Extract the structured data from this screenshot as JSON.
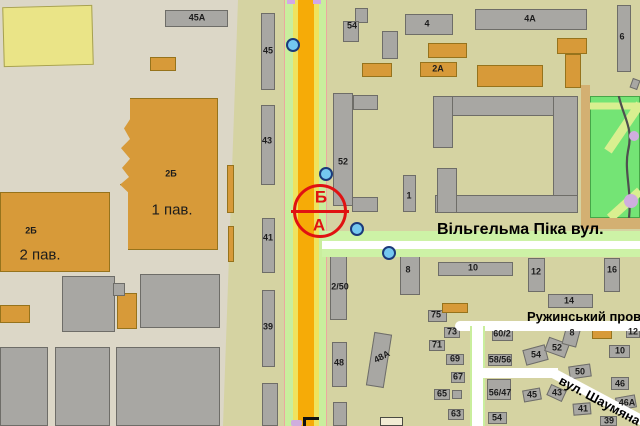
{
  "map": {
    "palette": {
      "district_left_bg": "#dcd7c7",
      "district_right_bg": "#d5d3a2",
      "building_gray": "#a8a7a3",
      "building_orange": "#d79a39",
      "building_yellow": "#eae487",
      "building_cream": "#f2ecd4",
      "road_orange": "#f6ab07",
      "road_yellow": "#efe35e",
      "road_green": "#c9ee9d",
      "street_white": "#ffffff",
      "street_green": "#cdf2a6",
      "marker_blue": "#74c8f0",
      "accent_red": "#e01212",
      "park_green": "#74e475",
      "park_path": "#d9ef90",
      "lavender": "#cfaede"
    },
    "streets": {
      "pika": {
        "label": "Вільгельма Піка вул."
      },
      "ruzhynskyi": {
        "label": "Ружинський пров."
      },
      "shaumiana": {
        "label": "вул. Шаумяна"
      }
    },
    "poi": {
      "top_label": "Б",
      "bottom_label": "А"
    },
    "blue_markers": [
      {
        "x": 293,
        "y": 45
      },
      {
        "x": 326,
        "y": 174
      },
      {
        "x": 357,
        "y": 229
      },
      {
        "x": 389,
        "y": 253
      }
    ],
    "buildings": [
      {
        "x": 3,
        "y": 6,
        "w": 90,
        "h": 60,
        "c": "y",
        "r": -1.5
      },
      {
        "x": 165,
        "y": 10,
        "w": 63,
        "h": 17,
        "c": "g"
      },
      {
        "x": 150,
        "y": 57,
        "w": 26,
        "h": 14,
        "c": "o"
      },
      {
        "x": 120,
        "y": 98,
        "w": 98,
        "h": 152,
        "c": "o",
        "j": 1
      },
      {
        "x": 0,
        "y": 192,
        "w": 110,
        "h": 80,
        "c": "o"
      },
      {
        "x": 62,
        "y": 276,
        "w": 53,
        "h": 56,
        "c": "g"
      },
      {
        "x": 140,
        "y": 274,
        "w": 80,
        "h": 54,
        "c": "g"
      },
      {
        "x": 117,
        "y": 293,
        "w": 20,
        "h": 36,
        "c": "o"
      },
      {
        "x": 113,
        "y": 283,
        "w": 12,
        "h": 13,
        "c": "g"
      },
      {
        "x": 0,
        "y": 305,
        "w": 30,
        "h": 18,
        "c": "o"
      },
      {
        "x": 0,
        "y": 347,
        "w": 48,
        "h": 79,
        "c": "g"
      },
      {
        "x": 55,
        "y": 347,
        "w": 55,
        "h": 79,
        "c": "g"
      },
      {
        "x": 116,
        "y": 347,
        "w": 104,
        "h": 79,
        "c": "g"
      },
      {
        "x": 227,
        "y": 165,
        "w": 7,
        "h": 48,
        "c": "o"
      },
      {
        "x": 228,
        "y": 226,
        "w": 6,
        "h": 36,
        "c": "o"
      },
      {
        "x": 261,
        "y": 13,
        "w": 14,
        "h": 77,
        "c": "g"
      },
      {
        "x": 261,
        "y": 105,
        "w": 14,
        "h": 80,
        "c": "g"
      },
      {
        "x": 262,
        "y": 218,
        "w": 13,
        "h": 55,
        "c": "g"
      },
      {
        "x": 262,
        "y": 290,
        "w": 13,
        "h": 77,
        "c": "g"
      },
      {
        "x": 262,
        "y": 383,
        "w": 16,
        "h": 43,
        "c": "g"
      },
      {
        "x": 355,
        "y": 8,
        "w": 13,
        "h": 15,
        "c": "g"
      },
      {
        "x": 343,
        "y": 21,
        "w": 16,
        "h": 21,
        "c": "g"
      },
      {
        "x": 405,
        "y": 14,
        "w": 48,
        "h": 21,
        "c": "g"
      },
      {
        "x": 475,
        "y": 9,
        "w": 112,
        "h": 21,
        "c": "g"
      },
      {
        "x": 617,
        "y": 5,
        "w": 14,
        "h": 67,
        "c": "g"
      },
      {
        "x": 382,
        "y": 31,
        "w": 16,
        "h": 28,
        "c": "g"
      },
      {
        "x": 428,
        "y": 43,
        "w": 39,
        "h": 15,
        "c": "o"
      },
      {
        "x": 420,
        "y": 62,
        "w": 37,
        "h": 15,
        "c": "o"
      },
      {
        "x": 362,
        "y": 63,
        "w": 30,
        "h": 14,
        "c": "o"
      },
      {
        "x": 477,
        "y": 65,
        "w": 66,
        "h": 22,
        "c": "o"
      },
      {
        "x": 557,
        "y": 38,
        "w": 30,
        "h": 16,
        "c": "o"
      },
      {
        "x": 565,
        "y": 54,
        "w": 16,
        "h": 34,
        "c": "o"
      },
      {
        "x": 631,
        "y": 79,
        "w": 8,
        "h": 10,
        "c": "g",
        "r": 20
      },
      {
        "x": 333,
        "y": 93,
        "w": 20,
        "h": 113,
        "c": "g"
      },
      {
        "x": 353,
        "y": 95,
        "w": 25,
        "h": 15,
        "c": "g"
      },
      {
        "x": 352,
        "y": 197,
        "w": 26,
        "h": 15,
        "c": "g"
      },
      {
        "x": 403,
        "y": 175,
        "w": 13,
        "h": 37,
        "c": "g"
      },
      {
        "x": 433,
        "y": 96,
        "w": 145,
        "h": 20,
        "c": "g"
      },
      {
        "x": 553,
        "y": 96,
        "w": 25,
        "h": 117,
        "c": "g"
      },
      {
        "x": 435,
        "y": 195,
        "w": 143,
        "h": 18,
        "c": "g"
      },
      {
        "x": 433,
        "y": 96,
        "w": 20,
        "h": 52,
        "c": "g"
      },
      {
        "x": 437,
        "y": 168,
        "w": 20,
        "h": 45,
        "c": "g"
      },
      {
        "x": 548,
        "y": 294,
        "w": 45,
        "h": 14,
        "c": "g"
      },
      {
        "x": 604,
        "y": 258,
        "w": 16,
        "h": 34,
        "c": "g"
      },
      {
        "x": 528,
        "y": 258,
        "w": 17,
        "h": 34,
        "c": "g"
      },
      {
        "x": 438,
        "y": 262,
        "w": 75,
        "h": 14,
        "c": "g"
      },
      {
        "x": 400,
        "y": 253,
        "w": 20,
        "h": 42,
        "c": "g"
      },
      {
        "x": 428,
        "y": 310,
        "w": 19,
        "h": 12,
        "c": "g"
      },
      {
        "x": 442,
        "y": 303,
        "w": 26,
        "h": 10,
        "c": "o"
      },
      {
        "x": 330,
        "y": 255,
        "w": 17,
        "h": 65,
        "c": "g"
      },
      {
        "x": 332,
        "y": 342,
        "w": 15,
        "h": 45,
        "c": "g"
      },
      {
        "x": 370,
        "y": 333,
        "w": 18,
        "h": 54,
        "c": "g",
        "r": 9
      },
      {
        "x": 333,
        "y": 402,
        "w": 14,
        "h": 24,
        "c": "g"
      },
      {
        "x": 380,
        "y": 417,
        "w": 23,
        "h": 9,
        "c": "cr"
      },
      {
        "x": 444,
        "y": 327,
        "w": 16,
        "h": 11,
        "c": "g"
      },
      {
        "x": 429,
        "y": 340,
        "w": 16,
        "h": 11,
        "c": "g"
      },
      {
        "x": 446,
        "y": 354,
        "w": 18,
        "h": 11,
        "c": "g"
      },
      {
        "x": 451,
        "y": 372,
        "w": 14,
        "h": 11,
        "c": "g"
      },
      {
        "x": 434,
        "y": 389,
        "w": 16,
        "h": 11,
        "c": "g"
      },
      {
        "x": 452,
        "y": 390,
        "w": 10,
        "h": 9,
        "c": "g"
      },
      {
        "x": 448,
        "y": 409,
        "w": 16,
        "h": 11,
        "c": "g"
      },
      {
        "x": 492,
        "y": 328,
        "w": 21,
        "h": 13,
        "c": "g"
      },
      {
        "x": 488,
        "y": 354,
        "w": 24,
        "h": 12,
        "c": "g"
      },
      {
        "x": 487,
        "y": 379,
        "w": 24,
        "h": 21,
        "c": "g"
      },
      {
        "x": 488,
        "y": 412,
        "w": 19,
        "h": 12,
        "c": "g"
      },
      {
        "x": 524,
        "y": 347,
        "w": 23,
        "h": 16,
        "c": "g",
        "r": -15
      },
      {
        "x": 546,
        "y": 340,
        "w": 22,
        "h": 15,
        "c": "g",
        "r": 20
      },
      {
        "x": 564,
        "y": 325,
        "w": 15,
        "h": 21,
        "c": "g",
        "r": 15
      },
      {
        "x": 592,
        "y": 325,
        "w": 20,
        "h": 14,
        "c": "o"
      },
      {
        "x": 626,
        "y": 327,
        "w": 14,
        "h": 11,
        "c": "g"
      },
      {
        "x": 609,
        "y": 345,
        "w": 21,
        "h": 13,
        "c": "g"
      },
      {
        "x": 569,
        "y": 365,
        "w": 22,
        "h": 13,
        "c": "g",
        "r": -8
      },
      {
        "x": 611,
        "y": 377,
        "w": 18,
        "h": 13,
        "c": "g"
      },
      {
        "x": 616,
        "y": 396,
        "w": 20,
        "h": 13,
        "c": "g",
        "r": -10
      },
      {
        "x": 523,
        "y": 389,
        "w": 18,
        "h": 12,
        "c": "g",
        "r": -10
      },
      {
        "x": 548,
        "y": 387,
        "w": 17,
        "h": 12,
        "c": "g",
        "r": 25
      },
      {
        "x": 573,
        "y": 403,
        "w": 18,
        "h": 12,
        "c": "g",
        "r": -5
      },
      {
        "x": 600,
        "y": 416,
        "w": 17,
        "h": 10,
        "c": "g"
      }
    ],
    "labels": [
      {
        "x": 197,
        "y": 18,
        "t": "45А"
      },
      {
        "x": 171,
        "y": 174,
        "t": "2Б"
      },
      {
        "x": 172,
        "y": 210,
        "t": "1 пав.",
        "s": "lg"
      },
      {
        "x": 31,
        "y": 231,
        "t": "2Б"
      },
      {
        "x": 40,
        "y": 255,
        "t": "2 пав.",
        "s": "lg"
      },
      {
        "x": 268,
        "y": 51,
        "t": "45"
      },
      {
        "x": 267,
        "y": 141,
        "t": "43"
      },
      {
        "x": 268,
        "y": 238,
        "t": "41"
      },
      {
        "x": 268,
        "y": 327,
        "t": "39"
      },
      {
        "x": 352,
        "y": 26,
        "t": "54"
      },
      {
        "x": 427,
        "y": 24,
        "t": "4"
      },
      {
        "x": 530,
        "y": 19,
        "t": "4А"
      },
      {
        "x": 622,
        "y": 37,
        "t": "6"
      },
      {
        "x": 438,
        "y": 69,
        "t": "2А"
      },
      {
        "x": 343,
        "y": 162,
        "t": "52"
      },
      {
        "x": 409,
        "y": 196,
        "t": "1"
      },
      {
        "x": 408,
        "y": 270,
        "t": "8"
      },
      {
        "x": 473,
        "y": 268,
        "t": "10"
      },
      {
        "x": 536,
        "y": 272,
        "t": "12"
      },
      {
        "x": 612,
        "y": 270,
        "t": "16"
      },
      {
        "x": 569,
        "y": 301,
        "t": "14"
      },
      {
        "x": 436,
        "y": 315,
        "t": "75"
      },
      {
        "x": 340,
        "y": 287,
        "t": "2/50"
      },
      {
        "x": 339,
        "y": 363,
        "t": "48"
      },
      {
        "x": 382,
        "y": 357,
        "t": "48А",
        "r": -28
      },
      {
        "x": 452,
        "y": 332,
        "t": "73"
      },
      {
        "x": 437,
        "y": 345,
        "t": "71"
      },
      {
        "x": 455,
        "y": 359,
        "t": "69"
      },
      {
        "x": 458,
        "y": 377,
        "t": "67"
      },
      {
        "x": 442,
        "y": 394,
        "t": "65"
      },
      {
        "x": 456,
        "y": 414,
        "t": "63"
      },
      {
        "x": 502,
        "y": 334,
        "t": "60/2"
      },
      {
        "x": 500,
        "y": 360,
        "t": "58/56"
      },
      {
        "x": 500,
        "y": 393,
        "t": "56/47"
      },
      {
        "x": 497,
        "y": 418,
        "t": "54"
      },
      {
        "x": 536,
        "y": 355,
        "t": "54"
      },
      {
        "x": 557,
        "y": 348,
        "t": "52"
      },
      {
        "x": 572,
        "y": 333,
        "t": "8"
      },
      {
        "x": 633,
        "y": 332,
        "t": "12"
      },
      {
        "x": 620,
        "y": 351,
        "t": "10"
      },
      {
        "x": 580,
        "y": 372,
        "t": "50"
      },
      {
        "x": 620,
        "y": 384,
        "t": "46"
      },
      {
        "x": 627,
        "y": 403,
        "t": "46А"
      },
      {
        "x": 532,
        "y": 395,
        "t": "45"
      },
      {
        "x": 557,
        "y": 393,
        "t": "43"
      },
      {
        "x": 583,
        "y": 409,
        "t": "41"
      },
      {
        "x": 609,
        "y": 421,
        "t": "39"
      }
    ]
  }
}
